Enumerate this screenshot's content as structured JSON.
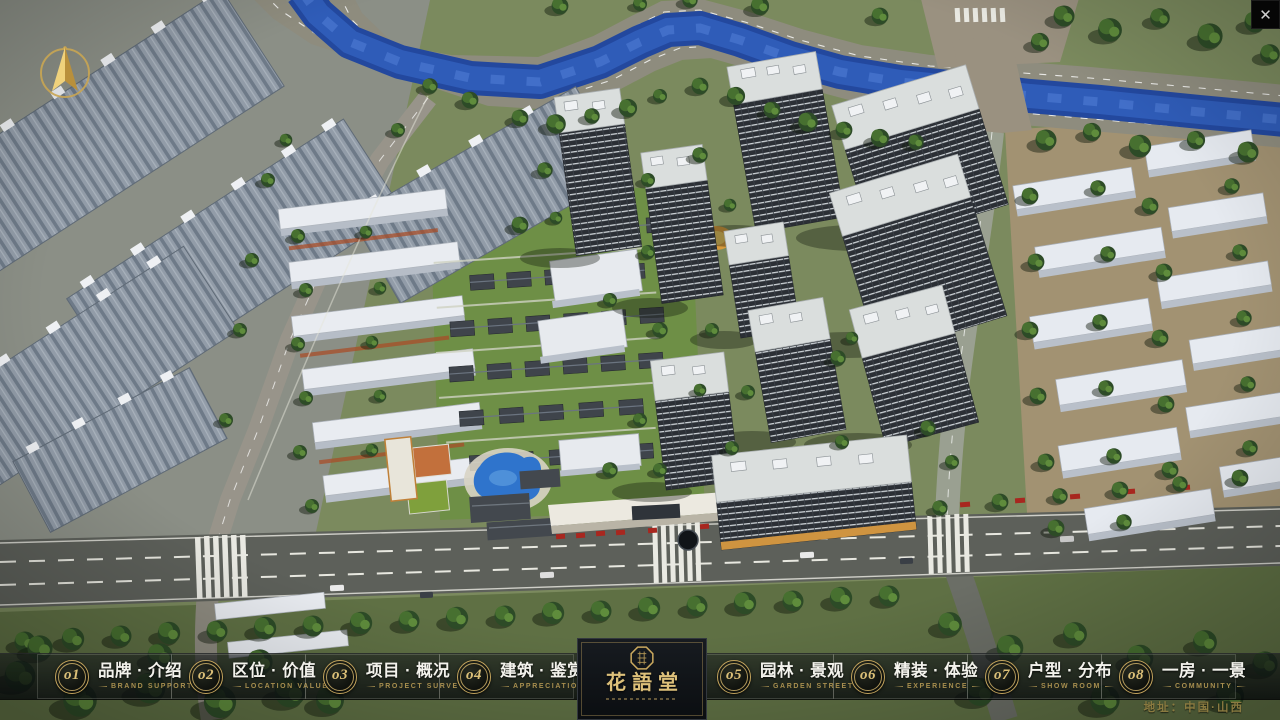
{
  "window": {
    "close": "✕"
  },
  "nav": {
    "items": [
      {
        "num": "o1",
        "zh": "品牌 · 介绍",
        "en": "BRAND SUPPORT"
      },
      {
        "num": "o2",
        "zh": "区位 · 价值",
        "en": "LOCATION VALUE"
      },
      {
        "num": "o3",
        "zh": "项目 · 概况",
        "en": "PROJECT SURVEY"
      },
      {
        "num": "o4",
        "zh": "建筑 · 鉴赏",
        "en": "APPRECIATION"
      },
      {
        "num": "o5",
        "zh": "园林 · 景观",
        "en": "GARDEN STREET"
      },
      {
        "num": "o6",
        "zh": "精装 · 体验",
        "en": "EXPERIENCE"
      },
      {
        "num": "o7",
        "zh": "户型 · 分布",
        "en": "SHOW ROOM"
      },
      {
        "num": "o8",
        "zh": "一房 · 一景",
        "en": "COMMUNITY"
      }
    ]
  },
  "logo": {
    "title": "花語堂"
  },
  "footer": {
    "address": "地址：中国·山西"
  },
  "colors": {
    "gold": "#c9a85e",
    "nav_text": "#f3f2ec",
    "nav_sub": "#a78e4e",
    "river": "#2a50a8",
    "road": "#5d605a",
    "grass": "#7b8a5e"
  }
}
